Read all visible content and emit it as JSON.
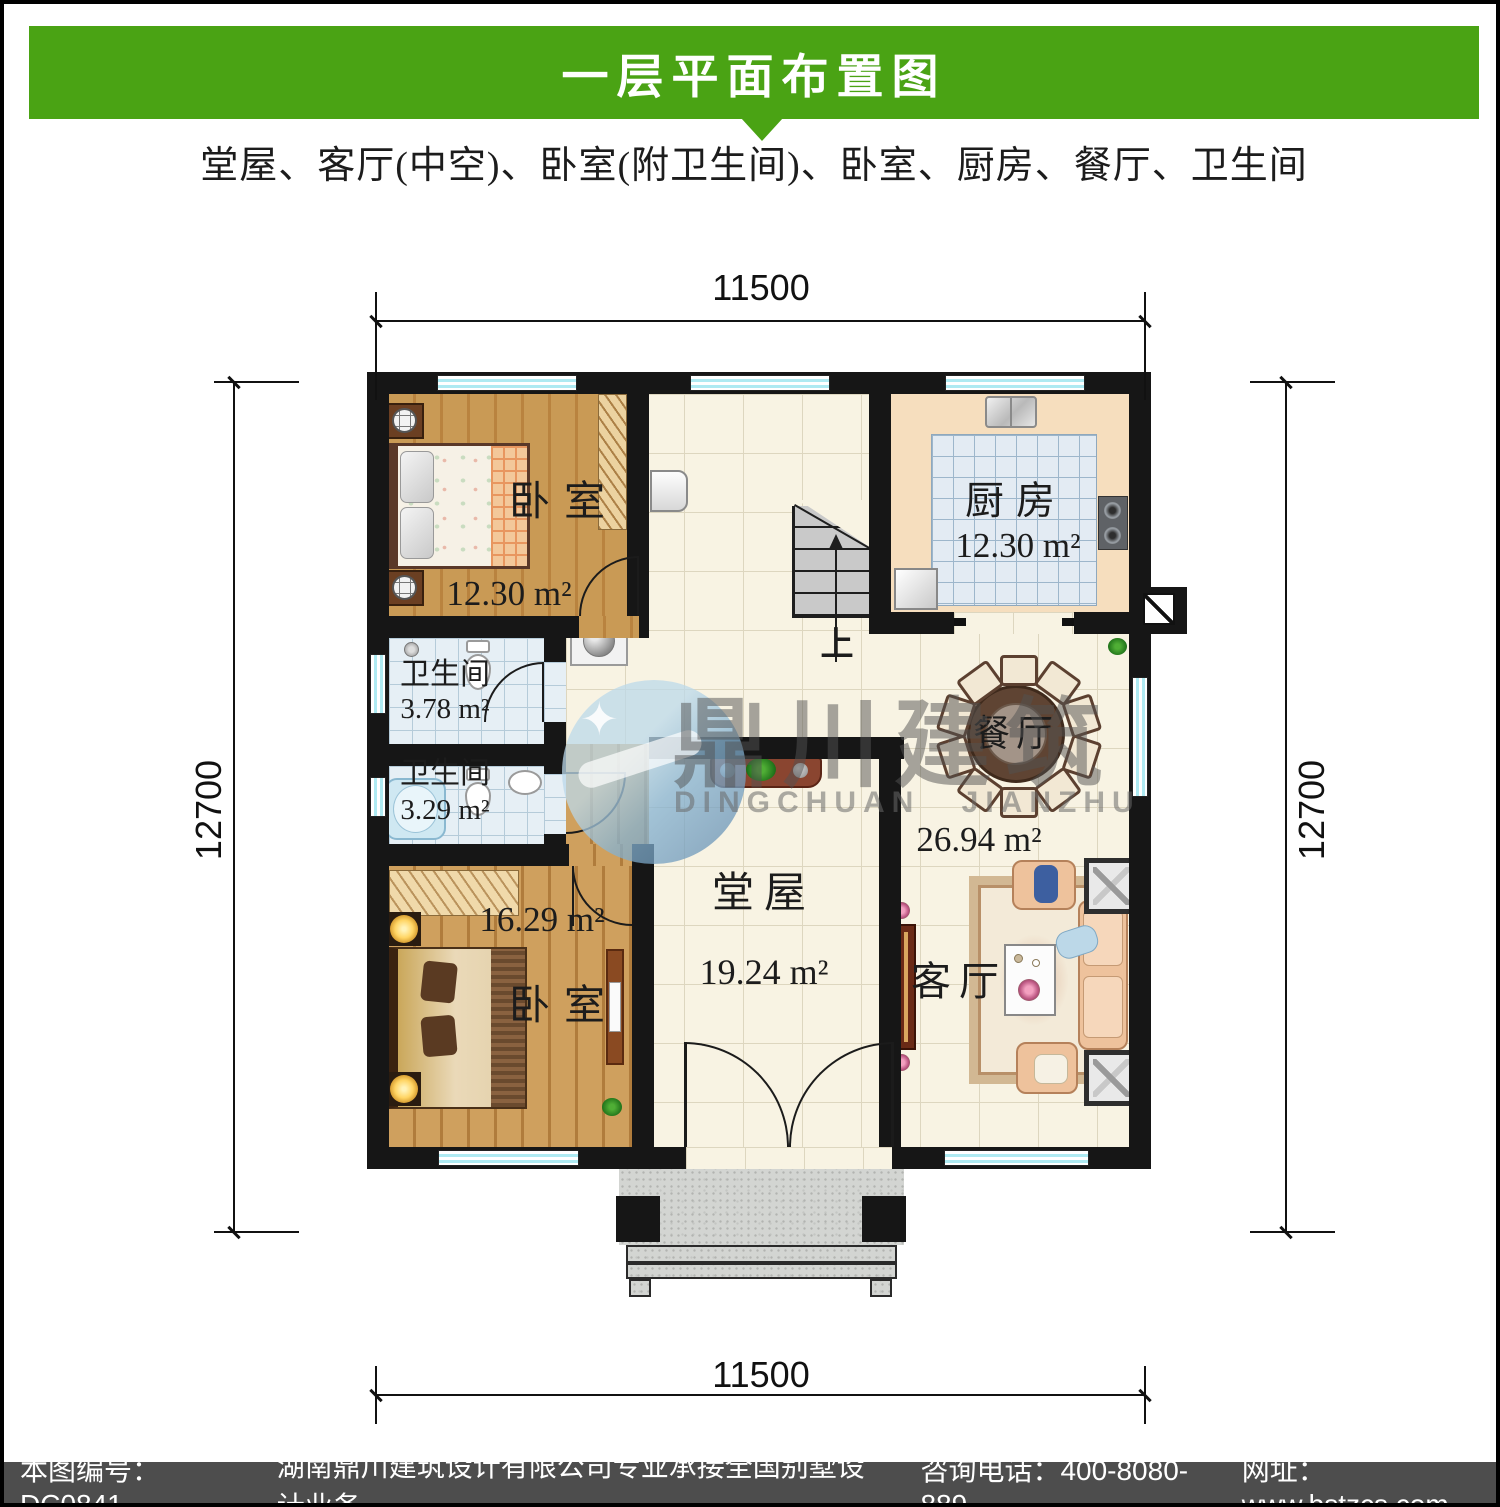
{
  "header": {
    "title": "一层平面布置图"
  },
  "subtitle": "堂屋、客厅(中空)、卧室(附卫生间)、卧室、厨房、餐厅、卫生间",
  "dims": {
    "top": "11500",
    "bottom": "11500",
    "left": "12700",
    "right": "12700"
  },
  "rooms": {
    "bedroom1": {
      "label": "卧室",
      "area": "12.30 m²"
    },
    "kitchen": {
      "label": "厨房",
      "area": "12.30 m²"
    },
    "bath1": {
      "label": "卫生间",
      "area": "3.78 m²"
    },
    "bath2": {
      "label": "卫生间",
      "area": "3.29 m²"
    },
    "dining": {
      "label": "餐厅",
      "area": "26.94 m²"
    },
    "hall": {
      "label": "堂屋",
      "area": "19.24 m²"
    },
    "bedroom2": {
      "label": "卧室",
      "area": "16.29 m²"
    },
    "living": {
      "label": "客厅"
    }
  },
  "stairs": {
    "up": "上"
  },
  "watermark": {
    "zh": "鼎川建筑",
    "en": "DINGCHUAN JIANZHU",
    "star": "✦"
  },
  "footer": {
    "code": "本图编号：DC0841",
    "company": "湖南鼎川建筑设计有限公司专业承接全国别墅设计业务",
    "phone": "咨询电话：400-8080-889",
    "website": "网址：www.bstzcs.com"
  },
  "colors": {
    "header_green": "#4aa314",
    "footer_gray": "#4d4d4d",
    "window_blue": "#aeeaf2",
    "wall_black": "#161616"
  }
}
